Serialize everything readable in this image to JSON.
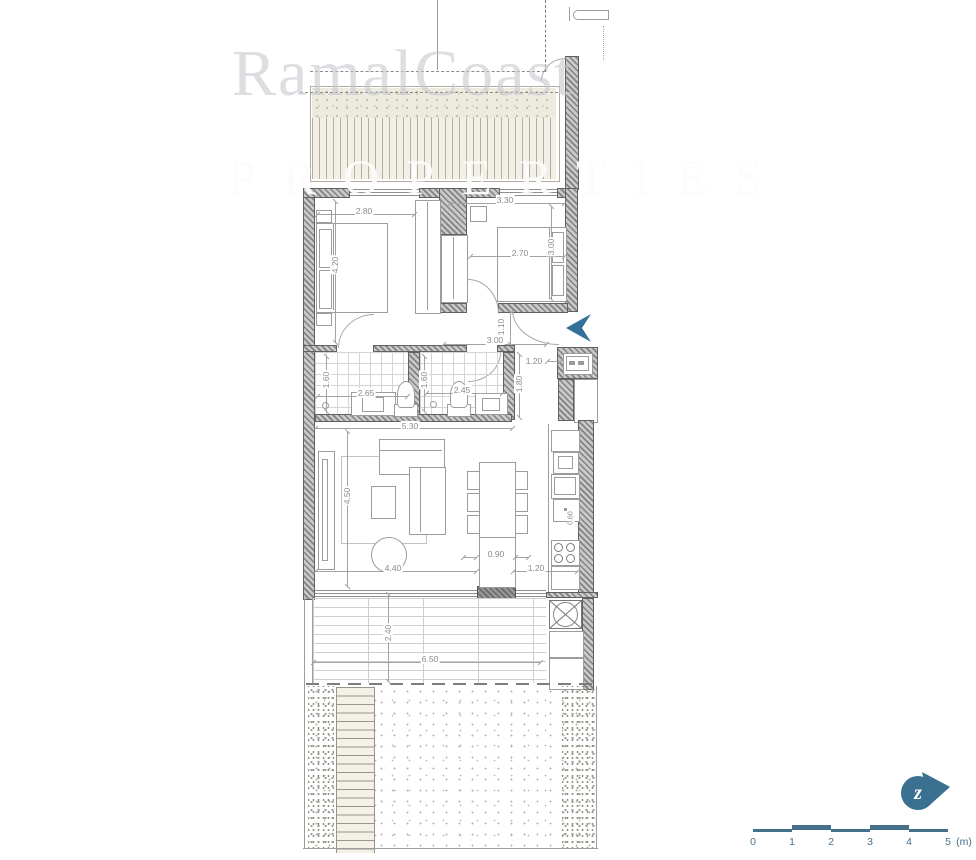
{
  "watermark": {
    "line1": "RamalCoast",
    "line2": "PROPERTIES"
  },
  "dimensions": {
    "bed1_width": "2.80",
    "bed1_depth": "4.20",
    "bed2_width": "3.30",
    "bed2_bed": "2.70",
    "bed2_depth": "3.00",
    "entry_depth": "1.10",
    "hall_width": "3.00",
    "laundry_width": "1.20",
    "bath1_depth": "1.60",
    "bath1_width": "2.65",
    "bath2_depth": "1.60",
    "bath2_width": "2.45",
    "bath2_side": "1.80",
    "baths_total": "5.30",
    "living_depth": "4.50",
    "living_width": "4.40",
    "island_width": "0.90",
    "kitchen_width": "1.20",
    "counter_depth": "0.60",
    "terrace_depth": "2.40",
    "terrace_width": "6.50"
  },
  "scale_bar": {
    "labels": [
      "0",
      "1",
      "2",
      "3",
      "4",
      "5"
    ],
    "unit": "(m)"
  },
  "north": {
    "glyph": "z"
  },
  "colors": {
    "accent": "#36719a",
    "scale": "#44708c",
    "wall": "#828282"
  }
}
